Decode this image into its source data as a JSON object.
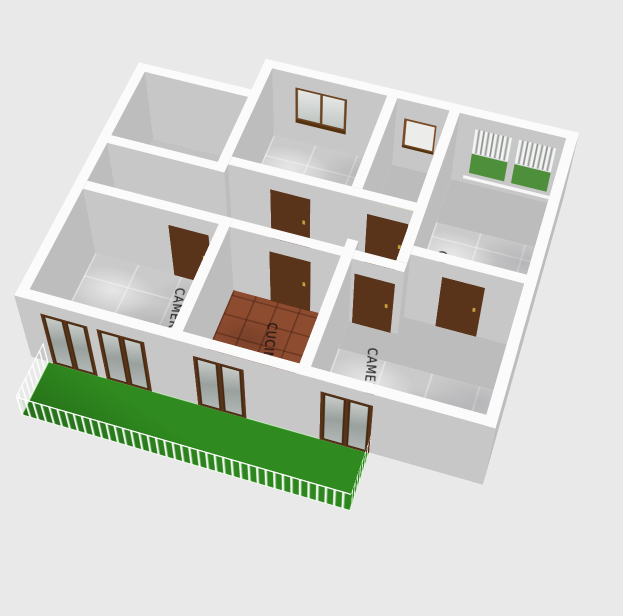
{
  "view": {
    "name": "3D floor plan view",
    "background": "#e9e9e9"
  },
  "rooms": [
    {
      "name": "storage-room",
      "label": "",
      "floor": "gray"
    },
    {
      "name": "bedroom-top",
      "label": "CAMERA",
      "floor": "marble"
    },
    {
      "name": "bathroom",
      "label": "",
      "floor": "green-tile"
    },
    {
      "name": "bedroom-right",
      "label": "CAMERA",
      "floor": "marble"
    },
    {
      "name": "bedroom-left",
      "label": "CAMERA",
      "floor": "marble"
    },
    {
      "name": "kitchen",
      "label": "CUCINA",
      "floor": "terracotta"
    },
    {
      "name": "bedroom-bottom",
      "label": "CAMERA",
      "floor": "marble"
    },
    {
      "name": "hallway",
      "label": "",
      "floor": "gray"
    },
    {
      "name": "balcony",
      "label": "",
      "floor": "green"
    }
  ],
  "colors": {
    "background": "#e9e9e9",
    "wall_cap": "#fbfbfb",
    "wall_face_south": "#c7c7c7",
    "wall_face_side": "#bdbdbd",
    "floor_gray": "#bcbcbc",
    "floor_gray_light": "#c2c2c2",
    "floor_marble": "#cacaca",
    "floor_terracotta": "#8d4b30",
    "floor_green_tile": "#c5e296",
    "balcony_floor": "#2f8a1f",
    "door": "#5a341a",
    "door_handle": "#c9a03c",
    "window_frame": "#6b4423",
    "window_shutter_green": "#4e8f3c",
    "railing": "#ffffff",
    "label_text": "#0b0b0b"
  }
}
